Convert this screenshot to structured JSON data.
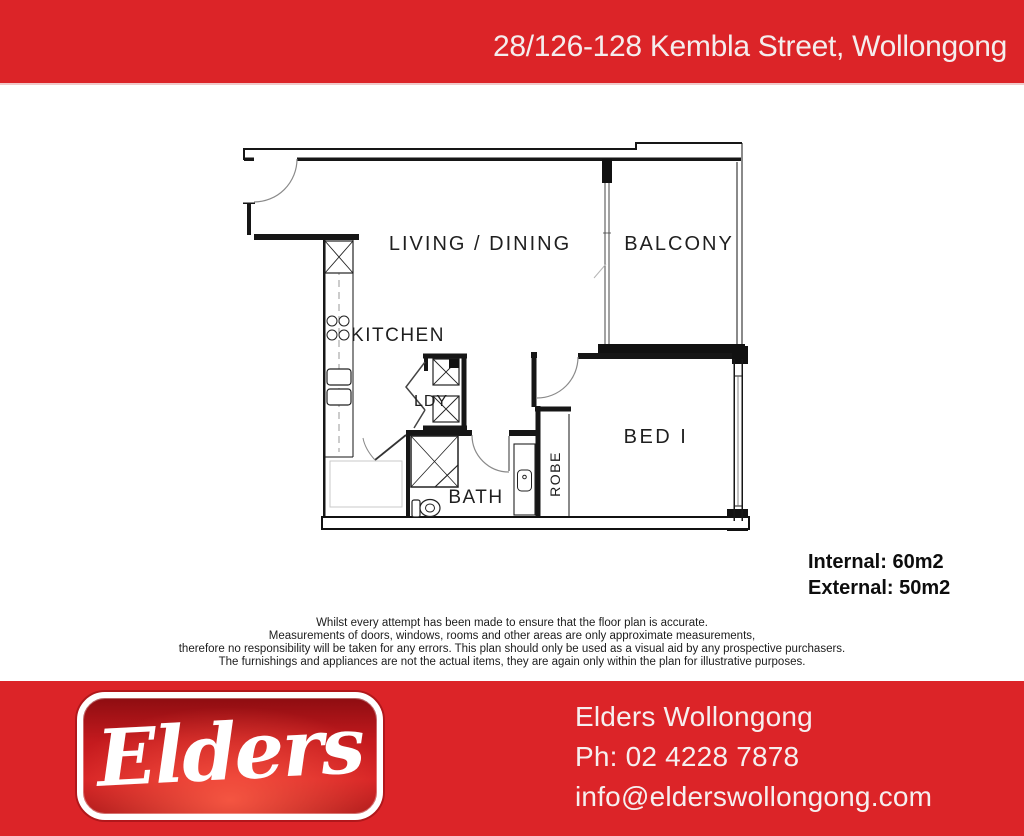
{
  "header": {
    "address": "28/126-128 Kembla Street, Wollongong"
  },
  "floor_plan": {
    "rooms": {
      "living": "LIVING / DINING",
      "balcony": "BALCONY",
      "kitchen": "KITCHEN",
      "laundry": "LDY",
      "bath": "BATH",
      "robe": "ROBE",
      "bed": "BED I"
    },
    "areas": {
      "internal": "Internal: 60m2",
      "external": "External: 50m2"
    }
  },
  "disclaimer": {
    "lines": [
      "Whilst every attempt has been made to ensure that the floor plan is accurate.",
      "Measurements of doors, windows, rooms and other areas are only approximate measurements,",
      "therefore no responsibility will be taken for any errors. This plan should only be used as a visual aid by any prospective purchasers.",
      "The furnishings and appliances are not the actual items, they are again only within the plan for illustrative purposes."
    ]
  },
  "footer": {
    "logo_text": "Elders",
    "office_name": "Elders Wollongong",
    "phone": "Ph: 02 4228 7878",
    "email": "info@elderswollongong.com"
  },
  "colors": {
    "brand_red": "#dc2428",
    "plan_line": "#161616"
  }
}
